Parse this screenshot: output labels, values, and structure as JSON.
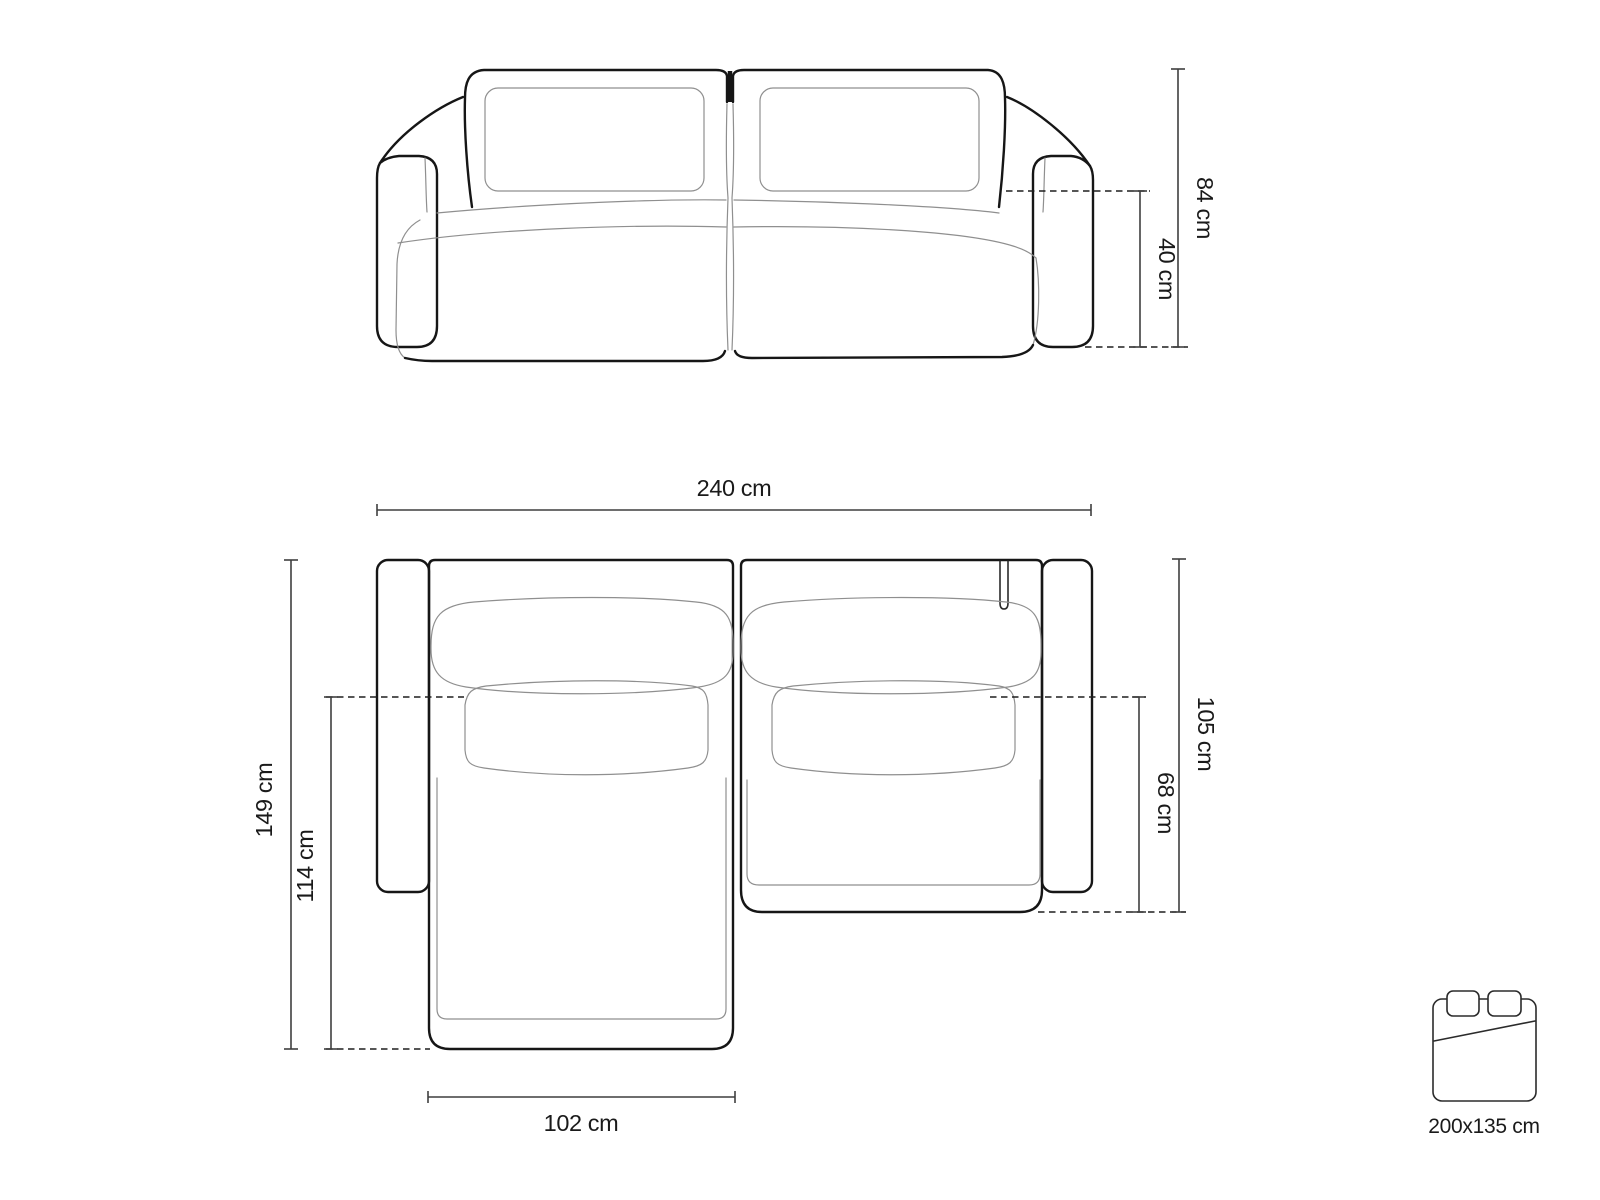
{
  "diagram_title": "corner-sofa-dimensions-diagram",
  "front_view": {
    "height_label": "84 cm",
    "seat_height_label": "40 cm"
  },
  "top_view": {
    "width_label": "240 cm",
    "depth_label": "149 cm",
    "chaise_depth_label": "114 cm",
    "body_depth_label": "105 cm",
    "seat_depth_label": "68 cm",
    "chaise_width_label": "102 cm"
  },
  "sleeping_area": {
    "size_label": "200x135 cm"
  },
  "colors": {
    "outline": "#161616",
    "light_line": "#8f8f8f",
    "dimension_line": "#3f3f3f",
    "text": "#1a1a1a",
    "background": "#ffffff"
  }
}
